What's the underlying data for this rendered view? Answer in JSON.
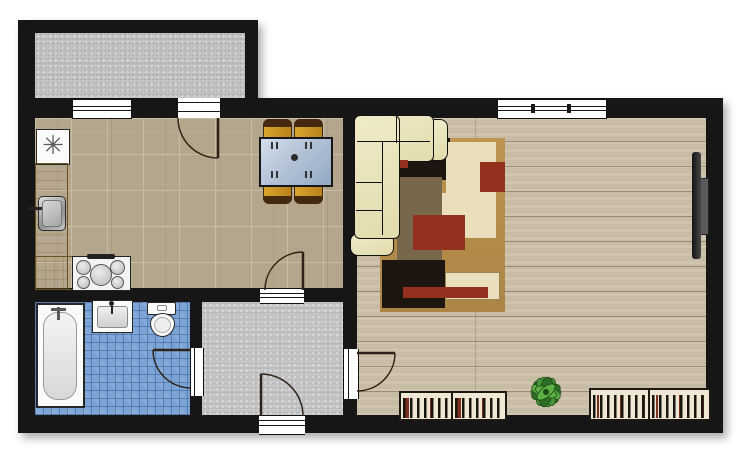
{
  "meta": {
    "type": "apartment-floor-plan-top-view",
    "width": 748,
    "height": 460,
    "visible_text": "none"
  },
  "symbols": {
    "freezer_asterisk": "✳"
  },
  "colors": {
    "wall": "#161616",
    "kitchenTile": "#b3a68c",
    "kitchenGrout": "#c9bda3",
    "wood": "#cdc1ab",
    "bathTile": "#7aa3d6",
    "hallFloor": "#c8c8ca",
    "balconyFloor": "#c4c4c6",
    "counterLight": "#e7cd85",
    "counterDark": "#d0ae58",
    "sofaCream": "#f0ebc8",
    "rugGold": "#bd9450",
    "rugCream": "#eadfbd",
    "rugOlive": "#77674b",
    "rugRed": "#93301e",
    "rugDark": "#1d150f",
    "chairGold": "#d9a62b",
    "chairBack": "#45290f",
    "tableGlassLight": "#d3deea",
    "tableGlassDark": "#93a9c2",
    "radiatorBg": "#efe7d3",
    "radiatorStripe": "#18140f",
    "radiatorRed": "#7c2e1f",
    "plantDark": "#2e6b24",
    "plantMid": "#47953a",
    "plantLight": "#5cb044",
    "steelLight": "#e2e2e2",
    "steelDark": "#8f8f8f",
    "tvDark": "#141414",
    "tvBracket": "#5a5a5a",
    "arc": "#2e2318"
  },
  "rooms": [
    {
      "id": "balcony",
      "floor": "gray-concrete"
    },
    {
      "id": "kitchen-dining",
      "floor": "beige-stone-tile"
    },
    {
      "id": "living-room",
      "floor": "wood-plank"
    },
    {
      "id": "bathroom",
      "floor": "blue-mosaic"
    },
    {
      "id": "entry-hall",
      "floor": "gray-concrete"
    }
  ],
  "furniture": [
    "freezer",
    "kitchen-counter-left",
    "kitchen-counter-bottom",
    "kitchen-sink",
    "stove-5-burner",
    "dining-table-glass",
    "dining-chair x4",
    "corner-sofa",
    "area-rug",
    "wall-tv",
    "radiator x4",
    "potted-plant",
    "bathtub",
    "washbasin",
    "toilet"
  ],
  "openings": [
    "window-kitchen-front",
    "window-living-room-front",
    "door-balcony-to-kitchen",
    "door-kitchen-to-hall",
    "door-hall-to-bathroom",
    "door-hall-to-living-room",
    "entrance-door"
  ]
}
